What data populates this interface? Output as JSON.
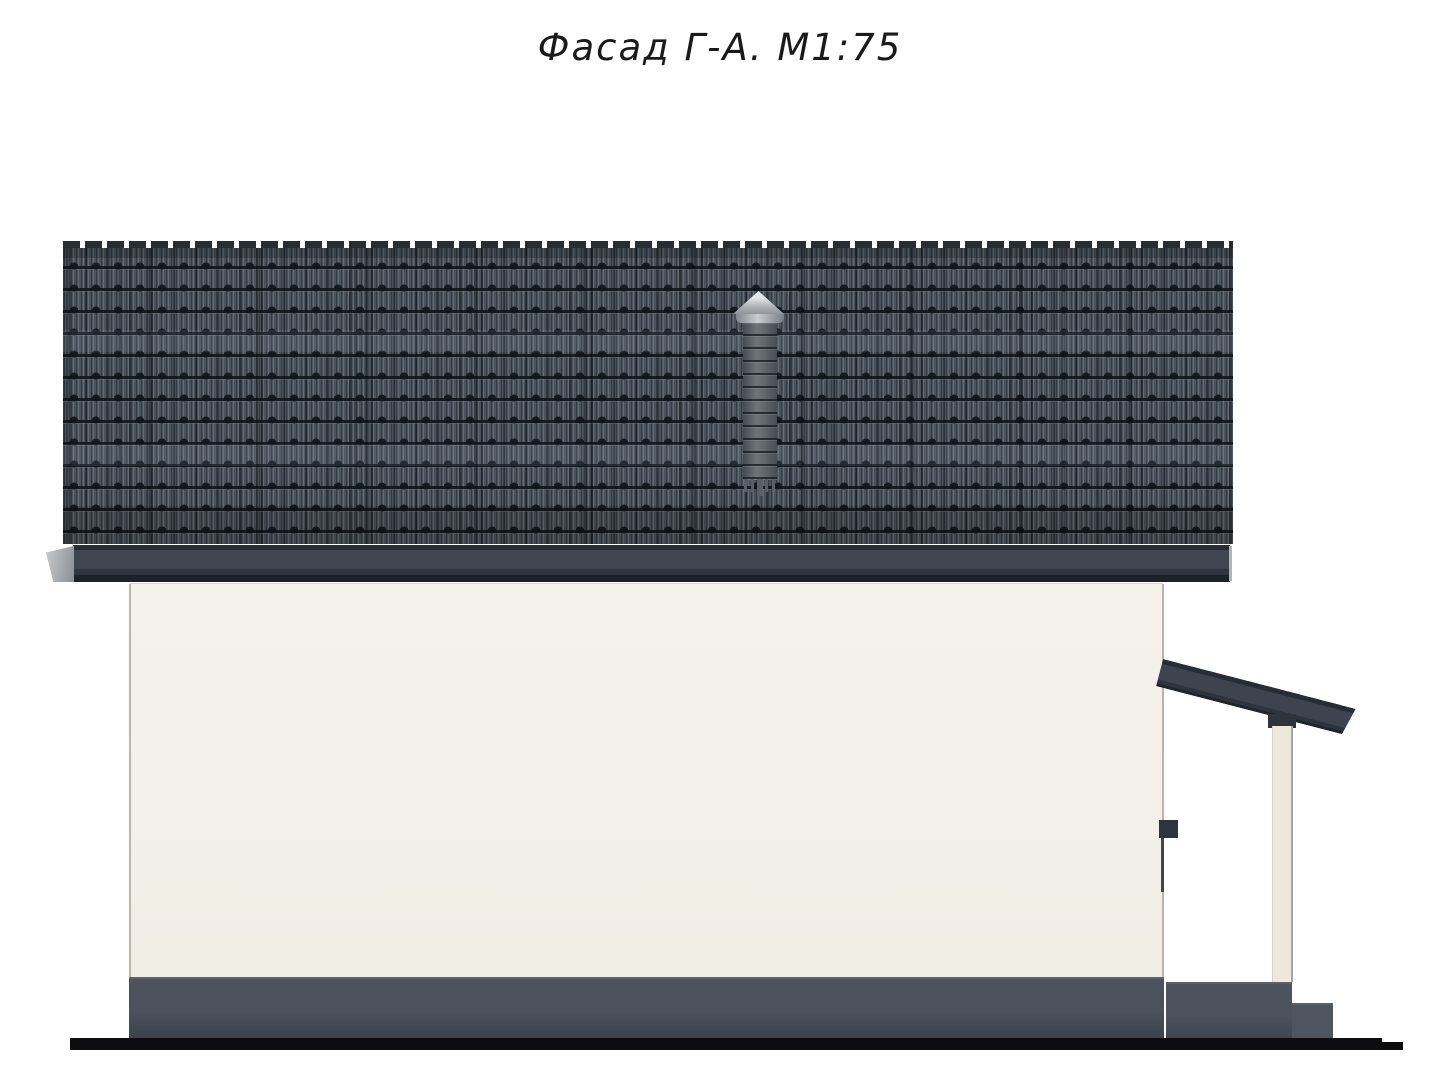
{
  "title": {
    "text": "Фасад Г-А. М1:75"
  },
  "palette": {
    "roof_tile": "#4a525b",
    "fascia": "#3f4650",
    "fascia_end_light": "#c6cacd",
    "wall": "#f1eee6",
    "wall_edge": "#b9b5ac",
    "plinth": "#4b525c",
    "porch_roof": "#3d444e",
    "post": "#ece8dc",
    "chimney_pipe": "#6d747b",
    "chimney_cap": "#c9cdd1",
    "ground_line": "#0d0d0f"
  },
  "elements": {
    "roof": "interlocking-tile gable roof, side elevation",
    "chimney": "roof vent stack with conical cap",
    "wall": "plastered facade wall",
    "plinth": "concrete base",
    "porch": "lean-to canopy with post, deck and step",
    "ground": "ground datum line"
  }
}
